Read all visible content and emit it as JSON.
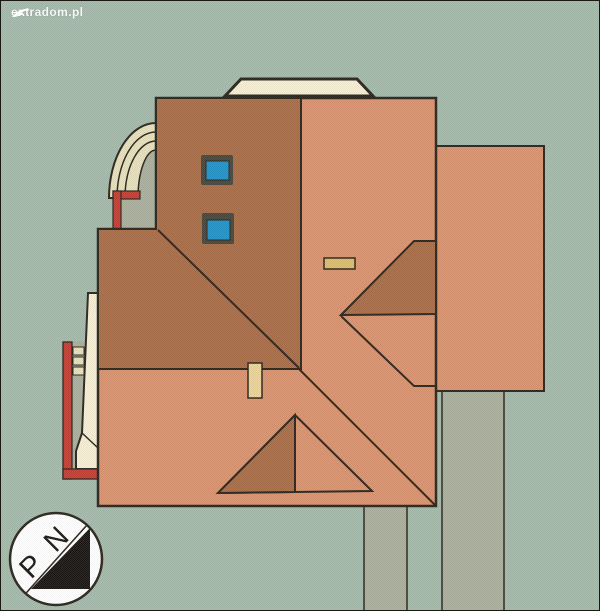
{
  "watermark": {
    "text": "extradom.pl"
  },
  "compass": {
    "label_p": "P",
    "label_n": "N"
  },
  "colors": {
    "background": "#a4b8ab",
    "outline": "#29231a",
    "roof_light": "#d8916f",
    "roof_dark": "#a86a48",
    "cream": "#f6eed4",
    "arc_band": "#e6dfbc",
    "gray_path": "#a9ae9b",
    "red_wall": "#c13c33",
    "chimney_tan": "#d9bc6d",
    "chimney_light": "#ead398",
    "skylight_blue": "#2191c5",
    "skylight_frame": "#46453c",
    "compass_ink": "#181512",
    "white": "#ffffff"
  }
}
